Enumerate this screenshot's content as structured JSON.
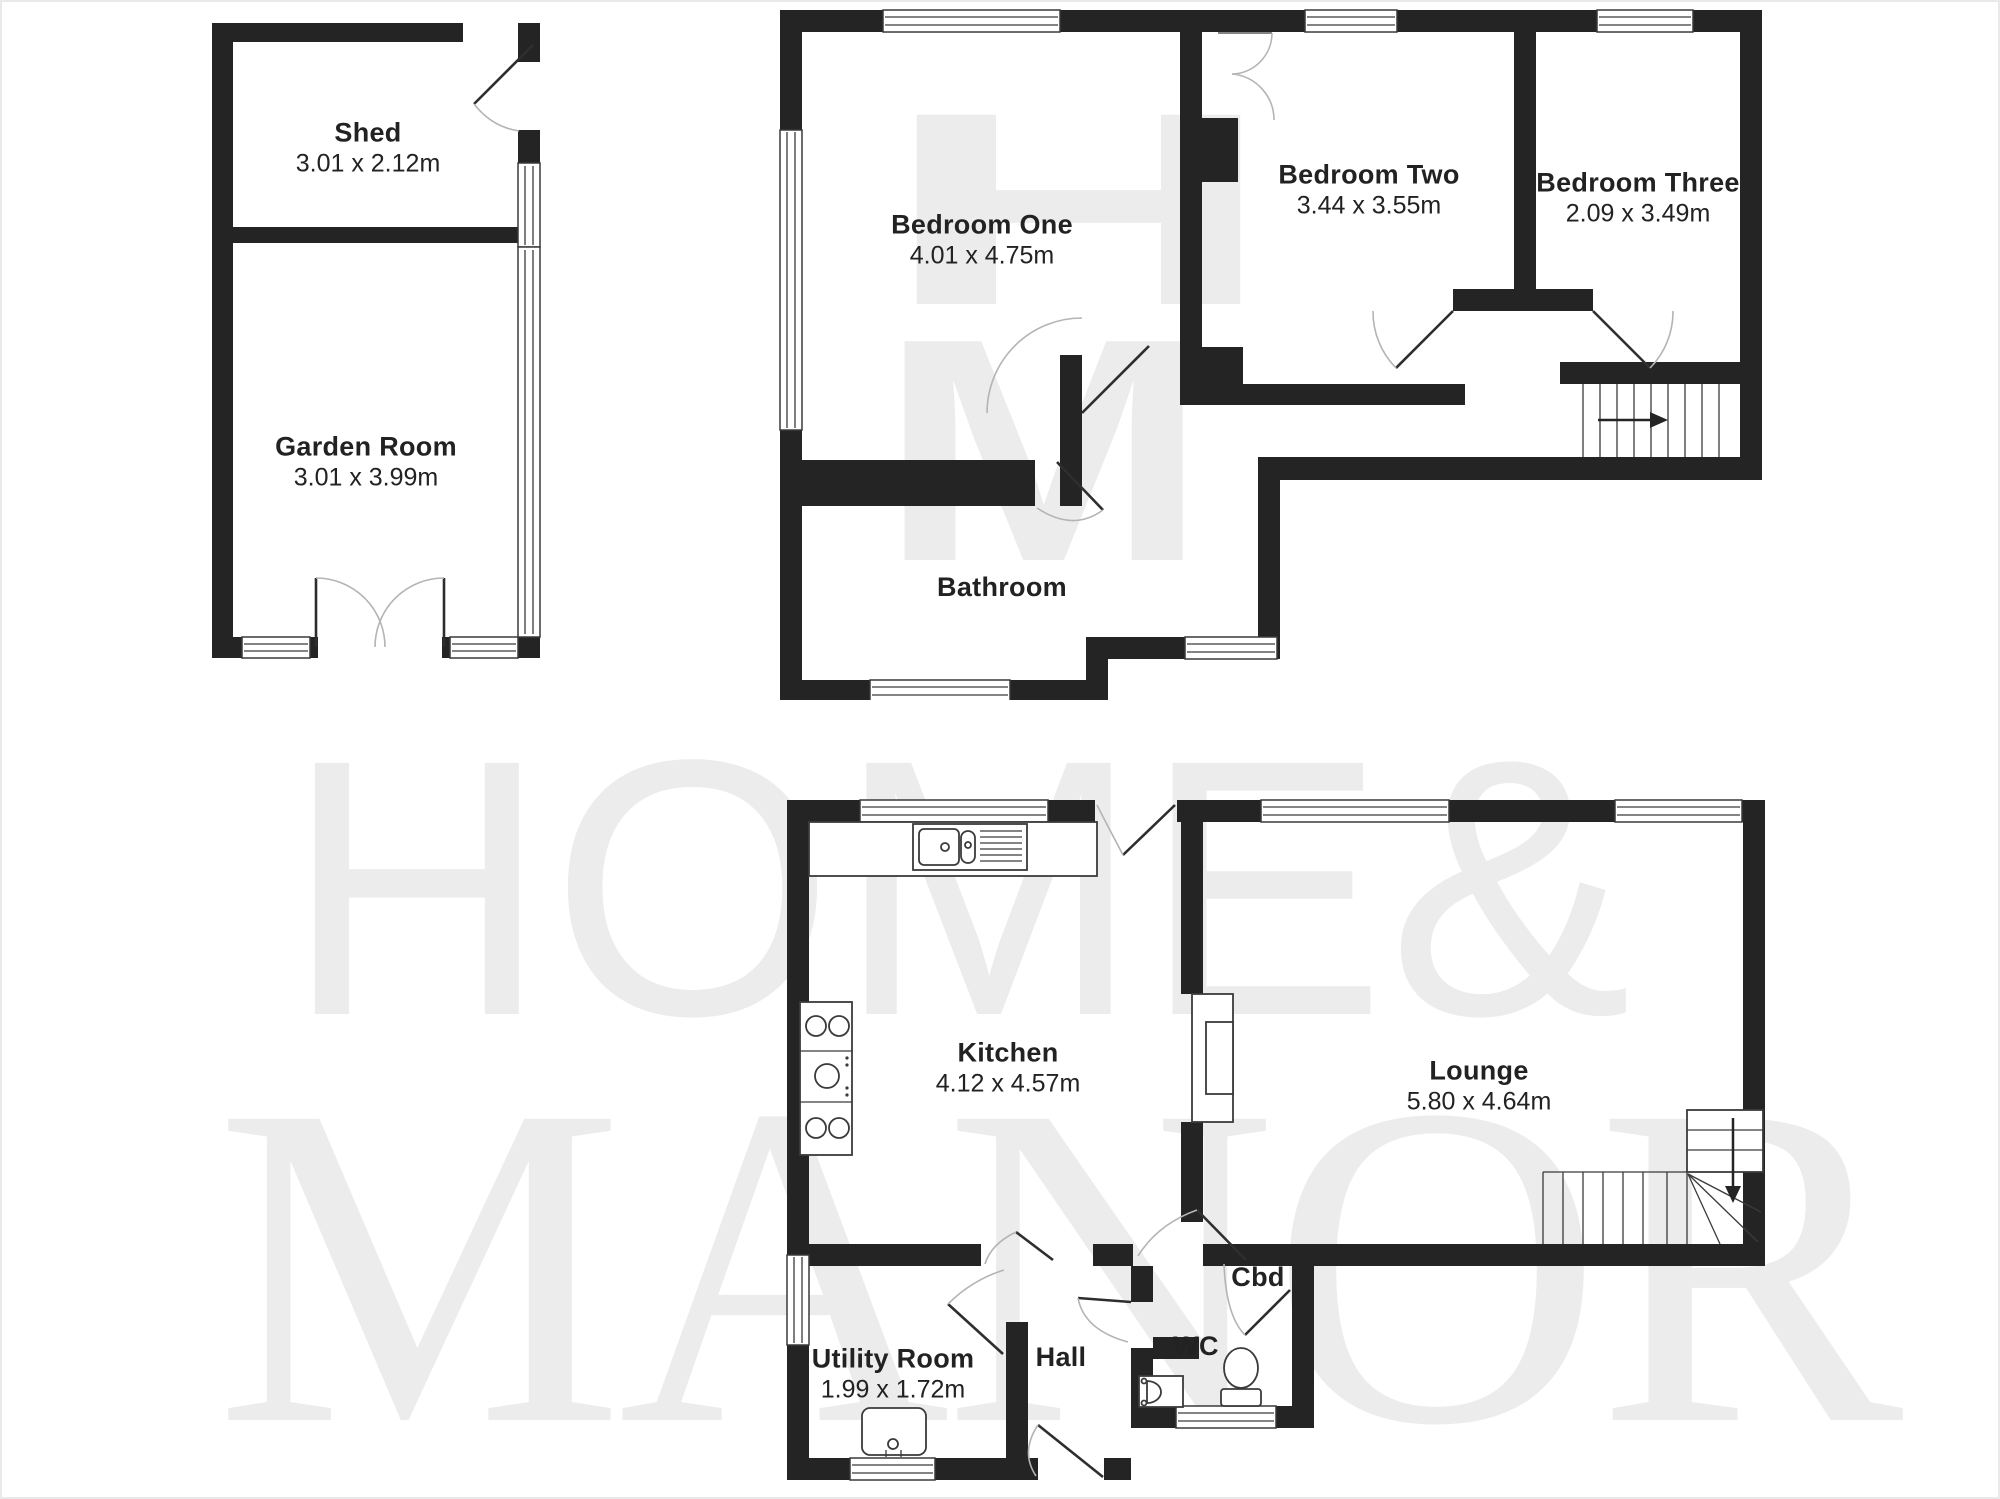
{
  "watermark": {
    "line1": "HOME&",
    "line2": "MANOR",
    "monogram_line1": "H",
    "monogram_line2": "M"
  },
  "plans": {
    "outbuilding": {
      "rooms": {
        "shed": {
          "name": "Shed",
          "dims": "3.01 x 2.12m"
        },
        "garden": {
          "name": "Garden Room",
          "dims": "3.01 x 3.99m"
        }
      }
    },
    "first_floor": {
      "rooms": {
        "bedroom_one": {
          "name": "Bedroom One",
          "dims": "4.01 x 4.75m"
        },
        "bedroom_two": {
          "name": "Bedroom Two",
          "dims": "3.44 x 3.55m"
        },
        "bedroom_three": {
          "name": "Bedroom Three",
          "dims": "2.09 x 3.49m"
        },
        "bathroom": {
          "name": "Bathroom"
        }
      }
    },
    "ground_floor": {
      "rooms": {
        "kitchen": {
          "name": "Kitchen",
          "dims": "4.12 x 4.57m"
        },
        "lounge": {
          "name": "Lounge",
          "dims": "5.80 x 4.64m"
        },
        "utility": {
          "name": "Utility Room",
          "dims": "1.99 x 1.72m"
        },
        "hall": {
          "name": "Hall"
        },
        "wc": {
          "name": "WC"
        },
        "cbd": {
          "name": "Cbd"
        }
      }
    }
  },
  "colors": {
    "wall": "#242424",
    "stroke": "#3a3a3a",
    "door_arc": "#b4b4b4",
    "door_leaf": "#2e2e2e",
    "watermark": "#ececec",
    "label": "#222222"
  }
}
